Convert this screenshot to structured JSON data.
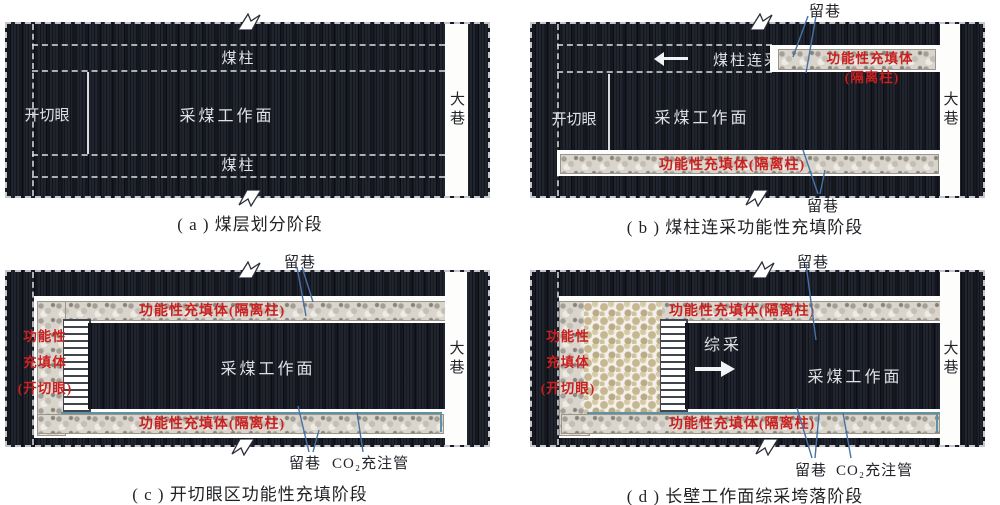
{
  "colors": {
    "coal": "#20242f",
    "fill_label_red": "#c92020",
    "leader_blue": "#4472a8",
    "co2_pipe_teal": "#5f93a3",
    "gravel_fill": "#d9d5cc",
    "goaf_rubble": "#c6b791"
  },
  "panel_a": {
    "caption": "( a ) 煤层划分阶段",
    "pillar_top": "煤柱",
    "pillar_bottom": "煤柱",
    "face": "采煤工作面",
    "open_cut": "开切眼",
    "main_roadway": "大巷"
  },
  "panel_b": {
    "caption": "( b ) 煤柱连采功能性充填阶段",
    "retained_roadway_top": "留巷",
    "retained_roadway_bottom": "留巷",
    "pillar_continuous_mining": "煤柱连采",
    "fill_top_line1": "功能性充填体",
    "fill_top_line2": "(隔离柱)",
    "fill_bottom": "功能性充填体(隔离柱)",
    "open_cut": "开切眼",
    "face": "采煤工作面",
    "main_roadway": "大巷"
  },
  "panel_c": {
    "caption": "( c ) 开切眼区功能性充填阶段",
    "retained_roadway_top": "留巷",
    "retained_roadway_bottom": "留巷",
    "co2_pipe": "CO₂充注管",
    "fill_top": "功能性充填体(隔离柱)",
    "fill_bottom": "功能性充填体(隔离柱)",
    "fill_left_line1": "功能性",
    "fill_left_line2": "充填体",
    "fill_left_line3": "(开切眼)",
    "face": "采煤工作面",
    "main_roadway": "大巷"
  },
  "panel_d": {
    "caption": "( d ) 长壁工作面综采垮落阶段",
    "retained_roadway_top": "留巷",
    "retained_roadway_bottom": "留巷",
    "co2_pipe": "CO₂充注管",
    "fill_top": "功能性充填体(隔离柱)",
    "fill_bottom": "功能性充填体(隔离柱)",
    "fill_left_line1": "功能性",
    "fill_left_line2": "充填体",
    "fill_left_line3": "(开切眼)",
    "mining": "综采",
    "face": "采煤工作面",
    "main_roadway": "大巷"
  }
}
